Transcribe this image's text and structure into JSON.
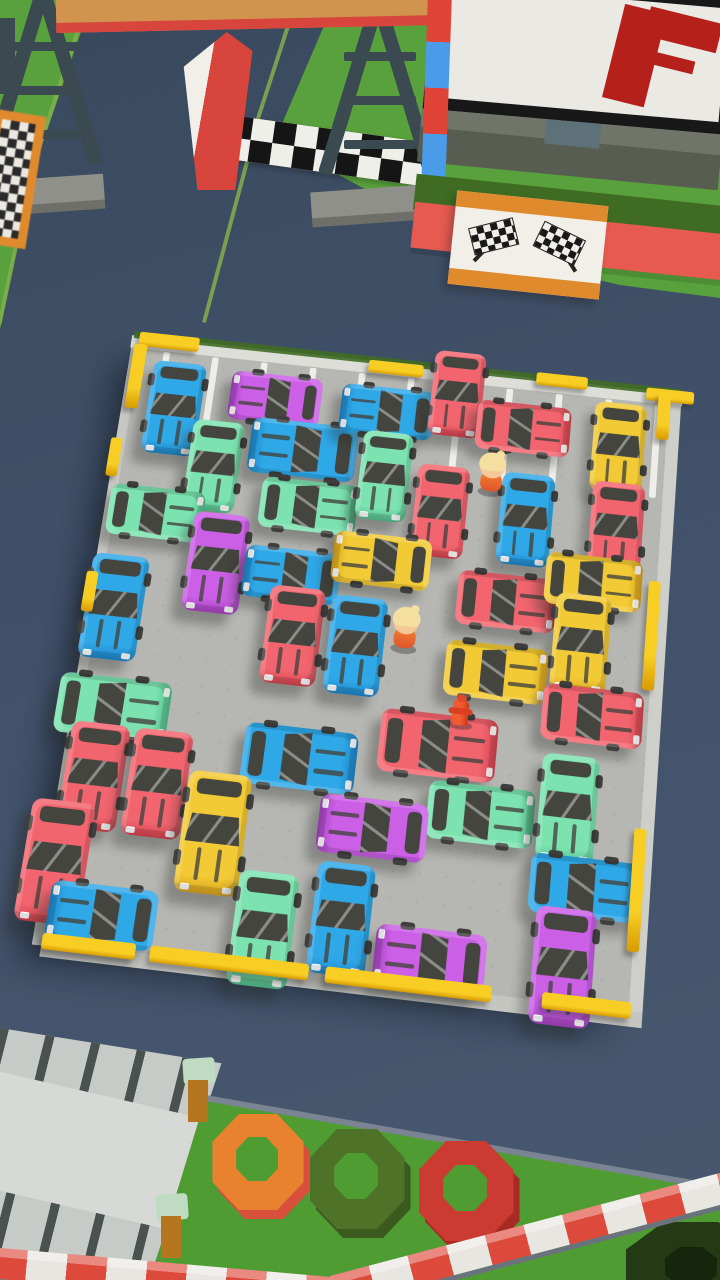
{
  "meta": {
    "app": "parking-jam-puzzle-game",
    "scene": "isometric parking lot level, no HUD text visible"
  },
  "palette": {
    "road": "#41516a",
    "roadline": "#84ae4e",
    "grass": "#58a13c",
    "grass2": "#4f9c33",
    "hedge": "#3f6b22",
    "floor": "#b6b6b2",
    "window": "#45453f",
    "yellow": "#f8ce25",
    "yellow-dark": "#d89b00",
    "beam": "#d0944e",
    "beam-edge": "#d8453c",
    "gantry": "#3b4a50",
    "gantry-base": "#8f9089",
    "gantry-base-dark": "#6e6f68",
    "frame": "#181818",
    "screen": "#ebe9e3",
    "flag-red": "#b5201a",
    "wall": "#70756a",
    "wall-dark": "#585d52",
    "stand": "#5e7078",
    "sign-orange": "#e08a2e",
    "sign-white": "#f2efe8",
    "pole-red": "#e04438",
    "pole-blue": "#4a9be8",
    "redwall": "#e65a50",
    "check-dark": "#151515",
    "check-light": "#efefea",
    "stripe-red": "#dd4a3c",
    "stripe-white": "#e8e6e0",
    "struct": "#c7cbc7",
    "struct-stripe": "#49524f",
    "post-brown": "#b5761f",
    "post-cap": "#bfdcc2",
    "skin": "#f6c897",
    "hair": "#f4dfa0",
    "shadow": "rgba(38,41,39,0.33)"
  },
  "car_colors": {
    "blue": {
      "body": "#2fa8e8",
      "shade": "#1f86c8"
    },
    "mint": {
      "body": "#7ce3b0",
      "shade": "#53be8c"
    },
    "red": {
      "body": "#f2656f",
      "shade": "#d6444f"
    },
    "yellow": {
      "body": "#f2ca35",
      "shade": "#d7a21c"
    },
    "purple": {
      "body": "#cb5fe6",
      "shade": "#a743c2"
    }
  },
  "lot": {
    "x": 90,
    "y": 355,
    "w": 560,
    "h": 610,
    "line_xs": [
      26,
      78,
      130,
      182,
      234,
      286,
      338,
      390,
      442,
      494,
      546
    ],
    "cars": [
      {
        "color": "blue",
        "facing": "down",
        "x": 46,
        "y": 63,
        "len": 102,
        "wid": 56
      },
      {
        "color": "purple",
        "facing": "left",
        "x": 150,
        "y": 41,
        "len": 96,
        "wid": 54
      },
      {
        "color": "mint",
        "facing": "down",
        "x": 96,
        "y": 121,
        "len": 98,
        "wid": 54
      },
      {
        "color": "blue",
        "facing": "left",
        "x": 186,
        "y": 93,
        "len": 112,
        "wid": 60
      },
      {
        "color": "blue",
        "facing": "left",
        "x": 268,
        "y": 42,
        "len": 98,
        "wid": 54
      },
      {
        "color": "red",
        "facing": "down",
        "x": 339,
        "y": 14,
        "len": 94,
        "wid": 54
      },
      {
        "color": "red",
        "facing": "right",
        "x": 411,
        "y": 44,
        "len": 98,
        "wid": 54
      },
      {
        "color": "yellow",
        "facing": "down",
        "x": 511,
        "y": 54,
        "len": 98,
        "wid": 54
      },
      {
        "color": "mint",
        "facing": "right",
        "x": 44,
        "y": 178,
        "len": 98,
        "wid": 54
      },
      {
        "color": "mint",
        "facing": "right",
        "x": 199,
        "y": 153,
        "len": 100,
        "wid": 54
      },
      {
        "color": "mint",
        "facing": "down",
        "x": 273,
        "y": 112,
        "len": 96,
        "wid": 52
      },
      {
        "color": "red",
        "facing": "down",
        "x": 334,
        "y": 143,
        "len": 98,
        "wid": 54
      },
      {
        "color": "blue",
        "facing": "down",
        "x": 422,
        "y": 142,
        "len": 98,
        "wid": 54
      },
      {
        "color": "red",
        "facing": "down",
        "x": 515,
        "y": 141,
        "len": 98,
        "wid": 54
      },
      {
        "color": "purple",
        "facing": "down",
        "x": 113,
        "y": 223,
        "len": 104,
        "wid": 58
      },
      {
        "color": "blue",
        "facing": "left",
        "x": 191,
        "y": 227,
        "len": 98,
        "wid": 54
      },
      {
        "color": "yellow",
        "facing": "left",
        "x": 280,
        "y": 202,
        "len": 100,
        "wid": 54
      },
      {
        "color": "red",
        "facing": "right",
        "x": 410,
        "y": 230,
        "len": 100,
        "wid": 56
      },
      {
        "color": "yellow",
        "facing": "right",
        "x": 496,
        "y": 200,
        "len": 98,
        "wid": 54
      },
      {
        "color": "blue",
        "facing": "down",
        "x": 17,
        "y": 280,
        "len": 108,
        "wid": 58
      },
      {
        "color": "red",
        "facing": "down",
        "x": 200,
        "y": 289,
        "len": 100,
        "wid": 56
      },
      {
        "color": "blue",
        "facing": "down",
        "x": 264,
        "y": 292,
        "len": 100,
        "wid": 56
      },
      {
        "color": "yellow",
        "facing": "down",
        "x": 488,
        "y": 264,
        "len": 100,
        "wid": 56
      },
      {
        "color": "yellow",
        "facing": "right",
        "x": 406,
        "y": 303,
        "len": 102,
        "wid": 56
      },
      {
        "color": "red",
        "facing": "right",
        "x": 505,
        "y": 336,
        "len": 100,
        "wid": 56
      },
      {
        "color": "mint",
        "facing": "right",
        "x": 32,
        "y": 381,
        "len": 112,
        "wid": 60
      },
      {
        "color": "blue",
        "facing": "right",
        "x": 222,
        "y": 410,
        "len": 112,
        "wid": 60
      },
      {
        "color": "red",
        "facing": "right",
        "x": 356,
        "y": 382,
        "len": 116,
        "wid": 62
      },
      {
        "color": "mint",
        "facing": "right",
        "x": 404,
        "y": 444,
        "len": 104,
        "wid": 56
      },
      {
        "color": "mint",
        "facing": "down",
        "x": 488,
        "y": 429,
        "len": 104,
        "wid": 56
      },
      {
        "color": "red",
        "facing": "down",
        "x": 24,
        "y": 450,
        "len": 104,
        "wid": 58
      },
      {
        "color": "red",
        "facing": "down",
        "x": 87,
        "y": 450,
        "len": 104,
        "wid": 58
      },
      {
        "color": "yellow",
        "facing": "down",
        "x": 148,
        "y": 491,
        "len": 116,
        "wid": 62
      },
      {
        "color": "purple",
        "facing": "left",
        "x": 301,
        "y": 469,
        "len": 106,
        "wid": 56
      },
      {
        "color": "blue",
        "facing": "right",
        "x": 510,
        "y": 502,
        "len": 106,
        "wid": 56
      },
      {
        "color": "red",
        "facing": "down",
        "x": 0,
        "y": 535,
        "len": 116,
        "wid": 62
      },
      {
        "color": "blue",
        "facing": "left",
        "x": 53,
        "y": 580,
        "len": 104,
        "wid": 56
      },
      {
        "color": "mint",
        "facing": "down",
        "x": 208,
        "y": 575,
        "len": 106,
        "wid": 58
      },
      {
        "color": "blue",
        "facing": "down",
        "x": 281,
        "y": 557,
        "len": 104,
        "wid": 56
      },
      {
        "color": "purple",
        "facing": "left",
        "x": 369,
        "y": 585,
        "len": 106,
        "wid": 56
      },
      {
        "color": "purple",
        "facing": "down",
        "x": 495,
        "y": 577,
        "len": 108,
        "wid": 58
      }
    ],
    "characters": [
      {
        "x": 383,
        "y": 98
      },
      {
        "x": 312,
        "y": 271
      }
    ],
    "hydrant": {
      "x": 375,
      "y": 346
    },
    "manhole": {
      "x": 390,
      "y": 66
    },
    "posts": [
      {
        "x": -2,
        "y": -18,
        "w": 64,
        "h": 16
      },
      {
        "x": -6,
        "y": -4,
        "w": 14,
        "h": 72
      },
      {
        "x": 243,
        "y": -14,
        "w": 58,
        "h": 14
      },
      {
        "x": 420,
        "y": -20,
        "w": 54,
        "h": 14
      },
      {
        "x": 536,
        "y": -16,
        "w": 50,
        "h": 14
      },
      {
        "x": 549,
        "y": -12,
        "w": 13,
        "h": 52
      },
      {
        "x": -14,
        "y": 102,
        "w": 12,
        "h": 42
      },
      {
        "x": -16,
        "y": 246,
        "w": 12,
        "h": 42
      },
      {
        "x": 552,
        "y": 192,
        "w": 12,
        "h": 112
      },
      {
        "x": 554,
        "y": 440,
        "w": 12,
        "h": 116
      }
    ],
    "curbs": [
      {
        "x": 0,
        "y": 602,
        "w": 90,
        "h": 15
      },
      {
        "x": 104,
        "y": 602,
        "w": 152,
        "h": 15
      },
      {
        "x": 272,
        "y": 602,
        "w": 158,
        "h": 15
      },
      {
        "x": 478,
        "y": 602,
        "w": 84,
        "h": 15
      }
    ]
  },
  "rings": [
    {
      "x": 258,
      "y": 1162,
      "r": 48,
      "color": "#e8822f",
      "under": "#d8503c",
      "edge": null
    },
    {
      "x": 357,
      "y": 1179,
      "r": 50,
      "color": "#4f7229",
      "under": "#3a5a1e",
      "edge": "#e6c45c"
    },
    {
      "x": 466,
      "y": 1191,
      "r": 50,
      "color": "#cc3b32",
      "under": "#a82a24",
      "edge": "#e6c45c"
    }
  ]
}
